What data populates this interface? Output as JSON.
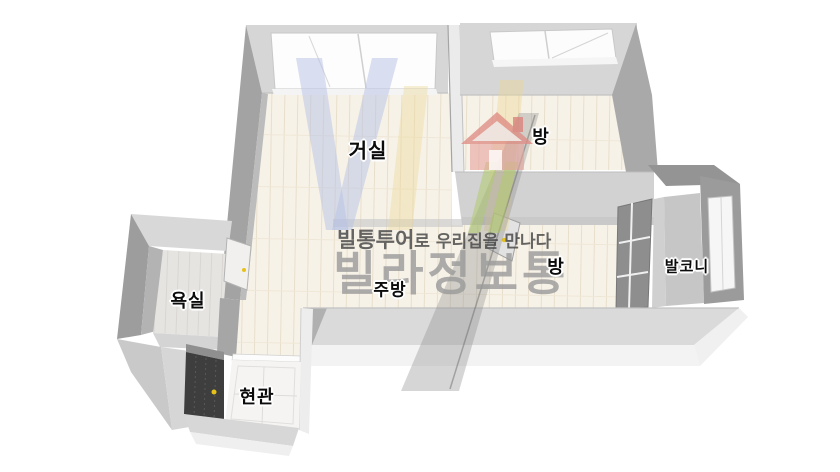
{
  "scene": {
    "type": "3d-floor-plan"
  },
  "rooms": {
    "living": {
      "label": "거실"
    },
    "bedroom_top": {
      "label": "방"
    },
    "bedroom_mid": {
      "label": "방"
    },
    "balcony": {
      "label": "발코니"
    },
    "bathroom": {
      "label": "욕실"
    },
    "kitchen": {
      "label": "주방"
    },
    "entrance": {
      "label": "현관"
    }
  },
  "watermark": {
    "slogan_bold": "빌통투어",
    "slogan_rest": "로 우리집을 만나다",
    "brand": "빌라정보통"
  },
  "colors": {
    "floor_wood": "#f7f2e8",
    "wall_top": "#d6d6d6",
    "wall_side": "#a3a3a3",
    "bath_floor": "#e6e4e1",
    "entry_floor": "#f5f4f2",
    "front_door": "#3e3e3e",
    "handle_yellow": "#e6c11a",
    "brand_gray": "#9a9a9a",
    "logo_blue": "#b6c2e3",
    "logo_yellow": "#ecd898",
    "logo_green": "#aeca6c",
    "logo_red": "#dd8d86"
  }
}
